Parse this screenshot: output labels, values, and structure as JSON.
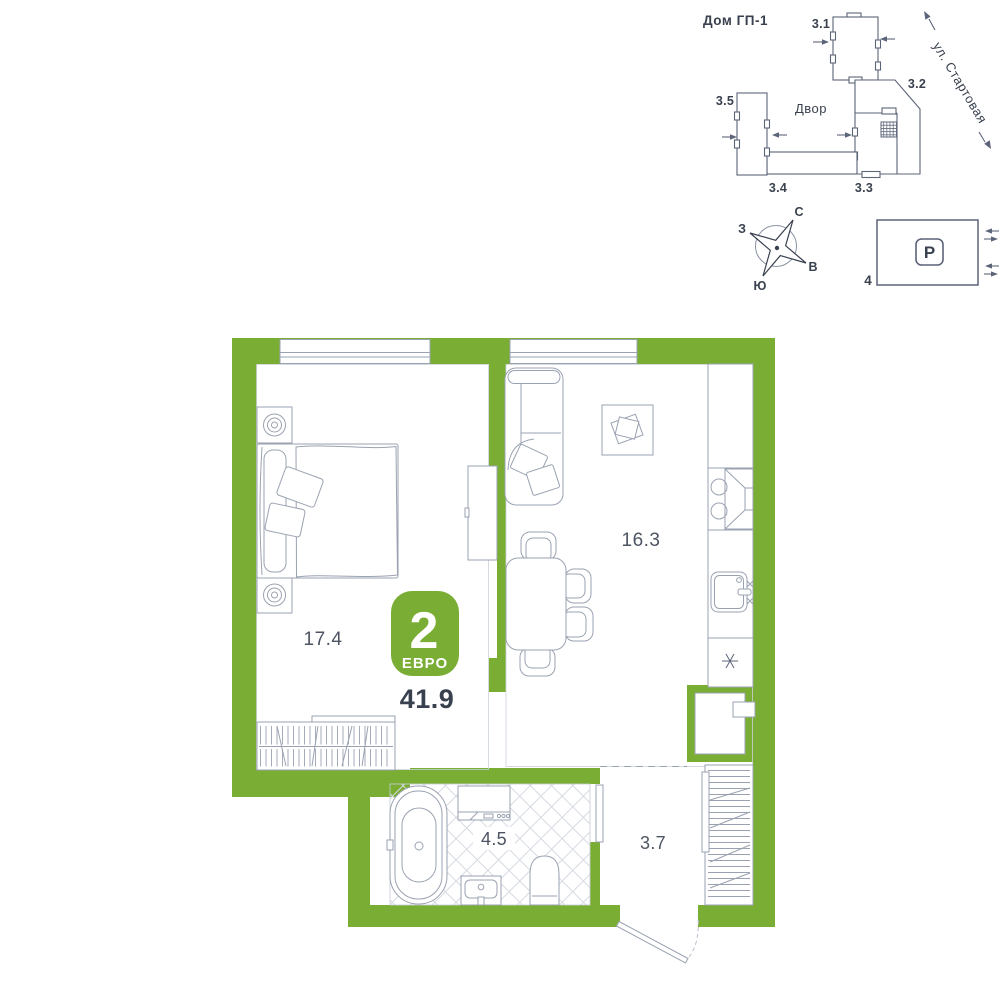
{
  "site_plan": {
    "title": "Дом ГП-1",
    "street_name": "ул. Стартовая",
    "courtyard_label": "Двор",
    "buildings": [
      "3.1",
      "3.2",
      "3.3",
      "3.4",
      "3.5"
    ]
  },
  "compass": {
    "north": "С",
    "west": "З",
    "east": "В",
    "south": "Ю"
  },
  "parking": {
    "sign": "P",
    "lot_number": "4"
  },
  "apartment": {
    "rooms_badge_number": "2",
    "rooms_badge_type": "ЕВРО",
    "total_area": "41.9",
    "bedroom_area": "17.4",
    "kitchen_living_area": "16.3",
    "bathroom_area": "4.5",
    "hallway_area": "3.7"
  },
  "colors": {
    "wall_accent": "#7aad33",
    "furniture_line": "#9aa2b1",
    "site_line": "#5b6478",
    "text_primary": "#39414f"
  }
}
